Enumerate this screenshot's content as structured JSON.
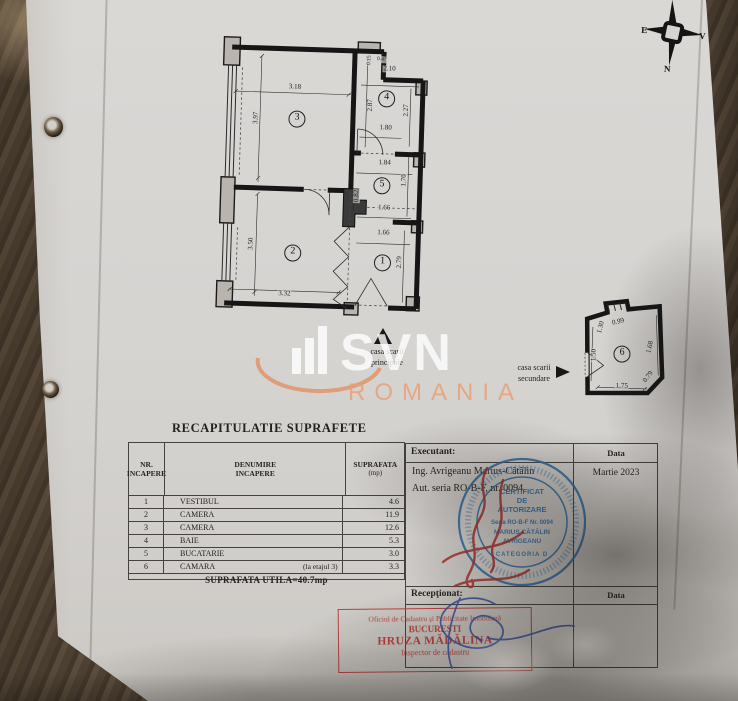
{
  "table_title": "RECAPITULATIE SUPRAFETE",
  "surface_table": {
    "col_headers": [
      [
        "NR.",
        "INCAPERE"
      ],
      [
        "DENUMIRE",
        "INCAPERE"
      ],
      [
        "SUPRAFATA",
        "(mp)"
      ]
    ],
    "rows": [
      {
        "nr": "1",
        "name": "VESTIBUL",
        "note": "",
        "area": "4.6"
      },
      {
        "nr": "2",
        "name": "CAMERA",
        "note": "",
        "area": "11.9"
      },
      {
        "nr": "3",
        "name": "CAMERA",
        "note": "",
        "area": "12.6"
      },
      {
        "nr": "4",
        "name": "BAIE",
        "note": "",
        "area": "5.3"
      },
      {
        "nr": "5",
        "name": "BUCATARIE",
        "note": "",
        "area": "3.0"
      },
      {
        "nr": "6",
        "name": "CAMARA",
        "note": "(la etajul 3)",
        "area": "3.3"
      }
    ],
    "footer": "SUPRAFATA UTILA=40.7mp"
  },
  "executant": {
    "label": "Executant:",
    "name": "Ing. Avrigeanu Marius-Cătălin",
    "authorization": "Aut. seria RO-B-F, nr. 0094",
    "data_label": "Data",
    "date": "Martie 2023"
  },
  "receptionat": {
    "label": "Recepţionat:",
    "data_label": "Data"
  },
  "stamps": {
    "blue": {
      "color": "#2e6ea6",
      "lines": [
        "CERTIFICAT",
        "DE",
        "AUTORIZARE",
        "Seria RO-B-F  Nr. 0094",
        "MARIUS CĂTĂLIN",
        "AVRIGEANU"
      ],
      "category": "CATEGORIA D"
    },
    "red": {
      "color": "#bd413c",
      "lines": [
        "Oficiul de Cadastru şi Publicitate Imobiliară",
        "BUCUREŞTI",
        "HRUZA MĂDĂLINA",
        "Inspector de cadastru"
      ]
    }
  },
  "captions": {
    "main_stairs": [
      "casa scarii",
      "principale"
    ],
    "secondary_stairs": [
      "casa scarii",
      "secundare"
    ]
  },
  "watermark": {
    "brand": "SVN",
    "country": "ROMANIA",
    "accent": "#e5a47c"
  },
  "compass": {
    "left": "E",
    "right": "V",
    "bottom": "N"
  },
  "floor_plan": {
    "main": {
      "rooms": [
        {
          "n": "3",
          "x": 87,
          "y": 84
        },
        {
          "n": "4",
          "x": 176,
          "y": 61
        },
        {
          "n": "5",
          "x": 174,
          "y": 148
        },
        {
          "n": "1",
          "x": 177,
          "y": 225
        },
        {
          "n": "2",
          "x": 87,
          "y": 218
        }
      ],
      "dims": [
        {
          "t": "3.18",
          "x": 84,
          "y": 52,
          "r": 0
        },
        {
          "t": "0.15",
          "x": 158,
          "y": 23,
          "r": -90,
          "s": 1
        },
        {
          "t": "0.47",
          "x": 170,
          "y": 22,
          "r": 0,
          "s": 1
        },
        {
          "t": "2.10",
          "x": 178,
          "y": 31,
          "r": 0
        },
        {
          "t": "3.97",
          "x": 46,
          "y": 84,
          "r": -90
        },
        {
          "t": "2.87",
          "x": 160,
          "y": 68,
          "r": -90
        },
        {
          "t": "2.27",
          "x": 196,
          "y": 72,
          "r": -90
        },
        {
          "t": "1.80",
          "x": 176,
          "y": 90,
          "r": 0
        },
        {
          "t": "1.84",
          "x": 176,
          "y": 125,
          "r": 0
        },
        {
          "t": "1.70",
          "x": 196,
          "y": 142,
          "r": -90
        },
        {
          "t": "0.82",
          "x": 149,
          "y": 159,
          "r": -90
        },
        {
          "t": "1.66",
          "x": 177,
          "y": 170,
          "r": 0
        },
        {
          "t": "1.66",
          "x": 177,
          "y": 195,
          "r": 0
        },
        {
          "t": "2.79",
          "x": 194,
          "y": 224,
          "r": -90
        },
        {
          "t": "3.50",
          "x": 45,
          "y": 210,
          "r": -90
        },
        {
          "t": "3.32",
          "x": 80,
          "y": 259,
          "r": 0
        }
      ]
    },
    "secondary": {
      "rooms": [
        {
          "n": "6",
          "x": 52,
          "y": 56
        }
      ],
      "dims": [
        {
          "t": "1.30",
          "x": 30,
          "y": 30,
          "r": -78
        },
        {
          "t": "0.99",
          "x": 47,
          "y": 24,
          "r": -15
        },
        {
          "t": "1.50",
          "x": 24,
          "y": 58,
          "r": -90
        },
        {
          "t": "1.68",
          "x": 80,
          "y": 48,
          "r": -80
        },
        {
          "t": "1.75",
          "x": 53,
          "y": 88,
          "r": 0
        },
        {
          "t": "0.79",
          "x": 79,
          "y": 78,
          "r": -55
        }
      ]
    }
  }
}
